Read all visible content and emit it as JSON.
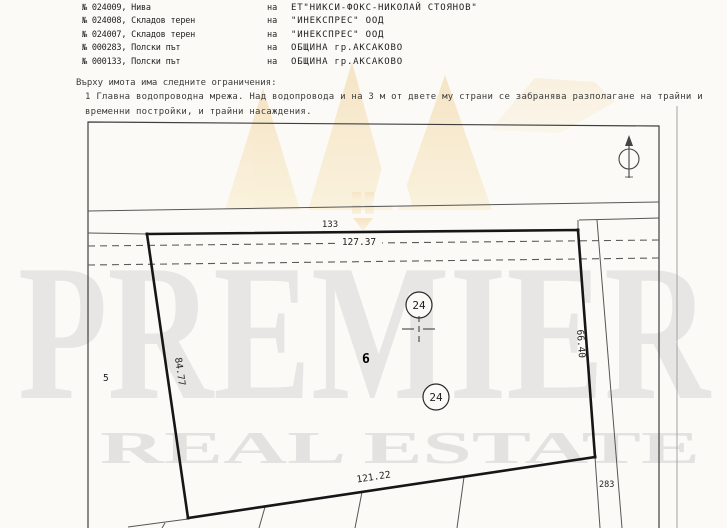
{
  "document": {
    "properties": [
      {
        "label": "№ 024009, Нива",
        "prep": "на",
        "owner": "ЕТ\"НИКСИ-ФОКС-НИКОЛАЙ СТОЯНОВ\""
      },
      {
        "label": "№ 024008, Складов терен",
        "prep": "на",
        "owner": "\"ИНЕКСПРЕС\" ООД"
      },
      {
        "label": "№ 024007, Складов терен",
        "prep": "на",
        "owner": "\"ИНЕКСПРЕС\" ООД"
      },
      {
        "label": "№ 000283, Полски път",
        "prep": "на",
        "owner": "ОБЩИНА гр.АКСАКОВО"
      },
      {
        "label": "№ 000133, Полски път",
        "prep": "на",
        "owner": "ОБЩИНА гр.АКСАКОВО"
      }
    ],
    "restrictions_heading": "Върху имота има следните ограничения:",
    "restrictions_line1": "1 Главна водопроводна мрежа. Над водопровода и на 3 м от двете му страни се забранява разполагане на трайни и",
    "restrictions_line2": "временни постройки, и трайни насаждения."
  },
  "sketch": {
    "dimensions": {
      "top_road_number": "133",
      "top_edge_length": "127.37",
      "left_edge_length": "84.77",
      "right_edge_length": "66.40",
      "bottom_edge_length": "121.22"
    },
    "parcel_circle_1": "24",
    "parcel_circle_2": "24",
    "building_mark": "6",
    "neighbor_left_number": "5",
    "road_right_number": "283",
    "line_color": "#1a1a1a",
    "thin_line_color": "#565656"
  },
  "watermark": {
    "brand": "PREMIER",
    "brand_sub": "REAL ESTATE",
    "grey": "#e7e6e4",
    "gold": "#e8a93c"
  }
}
